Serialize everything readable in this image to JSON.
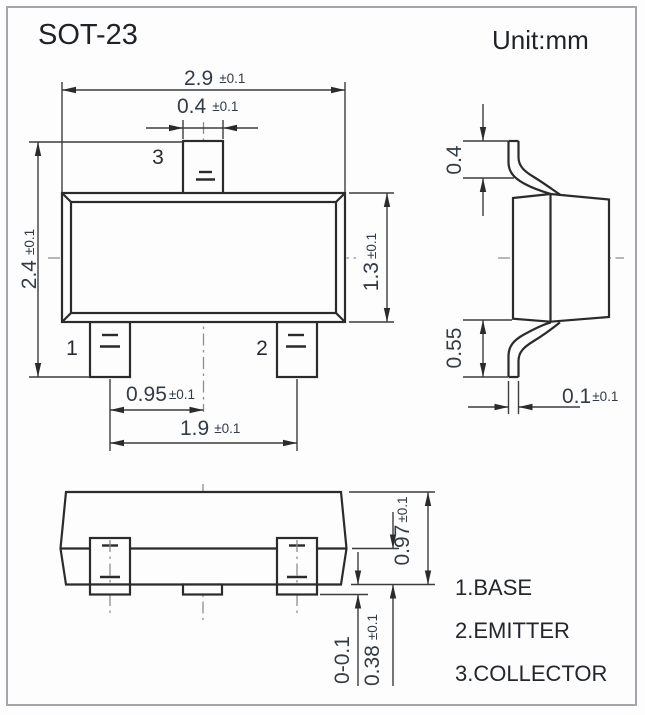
{
  "title": "SOT-23",
  "unit_label": "Unit:mm",
  "pin_numbers": {
    "pin1": "1",
    "pin2": "2",
    "pin3": "3"
  },
  "pin_functions": [
    "1.BASE",
    "2.EMITTER",
    "3.COLLECTOR"
  ],
  "dimensions": {
    "body_width": {
      "value": "2.9",
      "tol": "±0.1"
    },
    "tab_lead_width": {
      "value": "0.4",
      "tol": "±0.1"
    },
    "overall_depth": {
      "value": "2.4",
      "tol": "±0.1"
    },
    "body_depth": {
      "value": "1.3",
      "tol": "±0.1"
    },
    "lead_pitch": {
      "value": "0.95",
      "tol": "±0.1"
    },
    "lead_span": {
      "value": "1.9",
      "tol": "±0.1"
    },
    "lead_top_length": {
      "value": "0.4",
      "tol": ""
    },
    "lead_bottom_length": {
      "value": "0.55",
      "tol": ""
    },
    "lead_thickness": {
      "value": "0.1",
      "tol": "±0.1"
    },
    "profile_height": {
      "value": "0.97",
      "tol": "±0.1"
    },
    "lead_height": {
      "value": "0.38",
      "tol": "±0.1"
    },
    "standoff": {
      "value": "0-0.1",
      "tol": ""
    }
  },
  "colors": {
    "line": "#2b2b2b",
    "dim_text": "#333b45",
    "label_text": "#1f2227",
    "frame": "#a3a7ab",
    "background": "#fdfdfd"
  }
}
